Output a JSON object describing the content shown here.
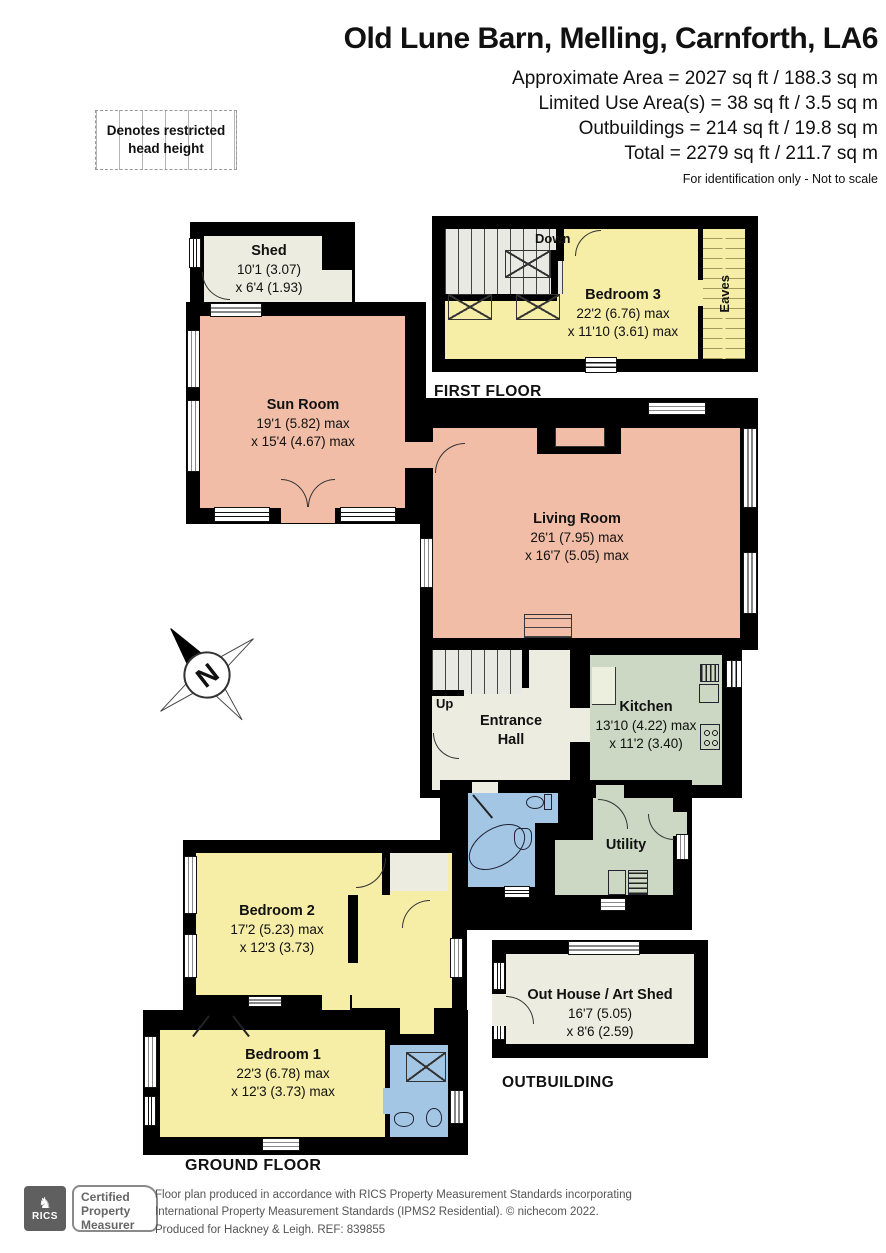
{
  "header": {
    "title": "Old Lune Barn, Melling, Carnforth, LA6",
    "area_lines": [
      "Approximate Area = 2027 sq ft / 188.3 sq m",
      "Limited Use Area(s) = 38 sq ft / 3.5 sq m",
      "Outbuildings = 214 sq ft / 19.8 sq m",
      "Total = 2279 sq ft / 211.7 sq m"
    ],
    "disclaimer": "For identification only - Not to scale"
  },
  "legend": {
    "text": "Denotes restricted head height"
  },
  "floors": {
    "first": {
      "label": "FIRST FLOOR",
      "stair_label": "Down",
      "eaves_label": "Eaves"
    },
    "ground": {
      "label": "GROUND FLOOR",
      "stair_label": "Up"
    },
    "outbuilding": {
      "label": "OUTBUILDING"
    }
  },
  "rooms": {
    "shed": {
      "name": "Shed",
      "dim1": "10'1 (3.07)",
      "dim2": "x 6'4 (1.93)"
    },
    "bedroom3": {
      "name": "Bedroom 3",
      "dim1": "22'2 (6.76) max",
      "dim2": "x 11'10 (3.61) max"
    },
    "sun_room": {
      "name": "Sun Room",
      "dim1": "19'1 (5.82) max",
      "dim2": "x 15'4 (4.67) max"
    },
    "living_room": {
      "name": "Living Room",
      "dim1": "26'1 (7.95) max",
      "dim2": "x 16'7 (5.05) max"
    },
    "entrance_hall": {
      "name_line1": "Entrance",
      "name_line2": "Hall"
    },
    "kitchen": {
      "name": "Kitchen",
      "dim1": "13'10 (4.22) max",
      "dim2": "x 11'2 (3.40)"
    },
    "utility": {
      "name": "Utility"
    },
    "bedroom2": {
      "name": "Bedroom 2",
      "dim1": "17'2 (5.23) max",
      "dim2": "x 12'3 (3.73)"
    },
    "bedroom1": {
      "name": "Bedroom 1",
      "dim1": "22'3 (6.78) max",
      "dim2": "x 12'3 (3.73) max"
    },
    "outhouse": {
      "name": "Out House / Art Shed",
      "dim1": "16'7 (5.05)",
      "dim2": "x 8'6 (2.59)"
    }
  },
  "compass": {
    "north_label": "N"
  },
  "footer": {
    "rics_label": "RICS",
    "badge_lines": [
      "Certified",
      "Property",
      "Measurer"
    ],
    "line1": "Floor plan produced in accordance with RICS Property Measurement Standards incorporating",
    "line2": "International Property Measurement Standards (IPMS2 Residential).   © nichecom 2022.",
    "line3": "Produced for Hackney & Leigh.   REF:  839855"
  },
  "colors": {
    "bedroom_yellow": "#f6eda6",
    "reception_salmon": "#f1bda7",
    "kitchen_green": "#ccd8c3",
    "bathroom_blue": "#a3c6e4",
    "shed_cream": "#ecece0",
    "stair_grey": "#e9e9e3",
    "wall_black": "#000000"
  }
}
